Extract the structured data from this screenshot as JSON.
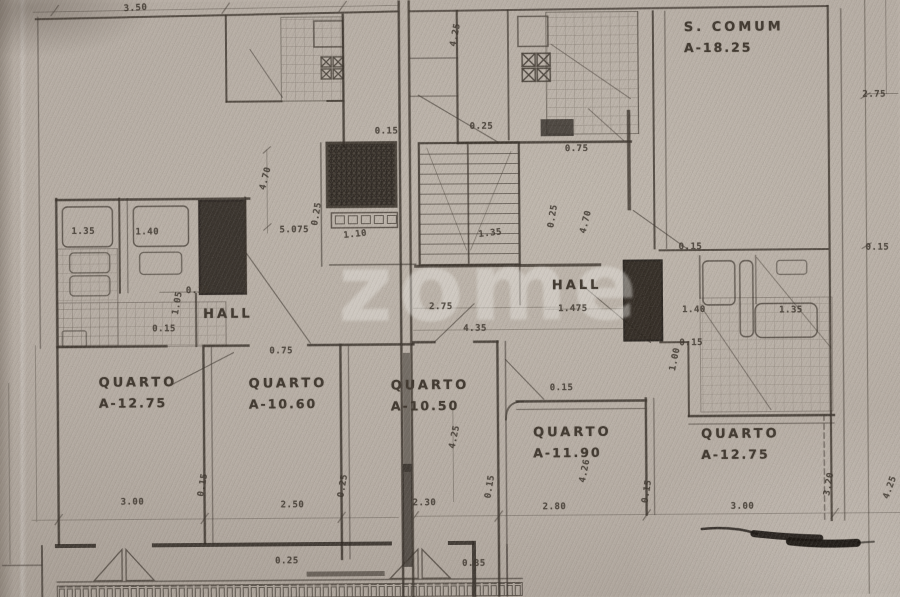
{
  "watermark": "zome",
  "rooms": [
    {
      "name": "S. COMUM",
      "area": "A-18.25",
      "x": 686,
      "y": 20
    },
    {
      "name": "HALL",
      "area": "",
      "x": 203,
      "y": 303
    },
    {
      "name": "HALL",
      "area": "",
      "x": 552,
      "y": 277
    },
    {
      "name": "QUARTO",
      "area": "A-12.75",
      "x": 98,
      "y": 371
    },
    {
      "name": "QUARTO",
      "area": "A-10.60",
      "x": 248,
      "y": 373
    },
    {
      "name": "QUARTO",
      "area": "A-10.50",
      "x": 390,
      "y": 376
    },
    {
      "name": "QUARTO",
      "area": "A-11.90",
      "x": 532,
      "y": 424
    },
    {
      "name": "QUARTO",
      "area": "A-12.75",
      "x": 700,
      "y": 427
    }
  ],
  "dimensions": [
    {
      "t": "3.50",
      "x": 126,
      "y": 1,
      "r": -3
    },
    {
      "t": "4.25",
      "x": 446,
      "y": 30,
      "r": -78
    },
    {
      "t": "0.15",
      "x": 376,
      "y": 126,
      "r": 0
    },
    {
      "t": "0.25",
      "x": 471,
      "y": 122,
      "r": 0
    },
    {
      "t": "0.75",
      "x": 566,
      "y": 145,
      "r": 0
    },
    {
      "t": "4.70",
      "x": 255,
      "y": 172,
      "r": -75
    },
    {
      "t": "0.25",
      "x": 306,
      "y": 208,
      "r": -80
    },
    {
      "t": "5.075",
      "x": 280,
      "y": 224,
      "r": 0
    },
    {
      "t": "1.10",
      "x": 344,
      "y": 229,
      "r": -6
    },
    {
      "t": "1.35",
      "x": 479,
      "y": 229,
      "r": -6
    },
    {
      "t": "0.25",
      "x": 542,
      "y": 212,
      "r": -80
    },
    {
      "t": "4.70",
      "x": 575,
      "y": 218,
      "r": -75
    },
    {
      "t": "1.35",
      "x": 72,
      "y": 224,
      "r": 0
    },
    {
      "t": "1.40",
      "x": 136,
      "y": 225,
      "r": 0
    },
    {
      "t": "0.15",
      "x": 186,
      "y": 284,
      "r": 0
    },
    {
      "t": "1.05",
      "x": 166,
      "y": 296,
      "r": -80
    },
    {
      "t": "0.15",
      "x": 152,
      "y": 322,
      "r": 0
    },
    {
      "t": "2.75",
      "x": 429,
      "y": 302,
      "r": 0
    },
    {
      "t": "1.475",
      "x": 558,
      "y": 305,
      "r": 0
    },
    {
      "t": "4.35",
      "x": 463,
      "y": 324,
      "r": 0
    },
    {
      "t": "0.75",
      "x": 269,
      "y": 345,
      "r": 0
    },
    {
      "t": "0.15",
      "x": 549,
      "y": 384,
      "r": 0
    },
    {
      "t": "4.25",
      "x": 442,
      "y": 432,
      "r": -78
    },
    {
      "t": "4.26",
      "x": 572,
      "y": 467,
      "r": -78
    },
    {
      "t": "0.15",
      "x": 679,
      "y": 244,
      "r": 0
    },
    {
      "t": "1.40",
      "x": 682,
      "y": 307,
      "r": 0
    },
    {
      "t": "1.35",
      "x": 779,
      "y": 308,
      "r": 0
    },
    {
      "t": "0.15",
      "x": 679,
      "y": 340,
      "r": 0
    },
    {
      "t": "1.00",
      "x": 663,
      "y": 356,
      "r": -78
    },
    {
      "t": "2.75",
      "x": 864,
      "y": 93,
      "r": 0
    },
    {
      "t": "0.15",
      "x": 866,
      "y": 246,
      "r": 0
    },
    {
      "t": "3.00",
      "x": 119,
      "y": 495,
      "r": 0
    },
    {
      "t": "0.15",
      "x": 190,
      "y": 478,
      "r": -80
    },
    {
      "t": "2.50",
      "x": 279,
      "y": 499,
      "r": 0
    },
    {
      "t": "0.25",
      "x": 330,
      "y": 480,
      "r": -80
    },
    {
      "t": "2.30",
      "x": 411,
      "y": 498,
      "r": 0
    },
    {
      "t": "0.15",
      "x": 477,
      "y": 482,
      "r": -80
    },
    {
      "t": "2.80",
      "x": 541,
      "y": 503,
      "r": 0
    },
    {
      "t": "0.15",
      "x": 634,
      "y": 488,
      "r": -80
    },
    {
      "t": "3.00",
      "x": 729,
      "y": 504,
      "r": 0
    },
    {
      "t": "3.20",
      "x": 816,
      "y": 482,
      "r": -80
    },
    {
      "t": "4.25",
      "x": 877,
      "y": 486,
      "r": -70
    },
    {
      "t": "0.25",
      "x": 273,
      "y": 555,
      "r": 0
    },
    {
      "t": "0.85",
      "x": 460,
      "y": 559,
      "r": 0
    }
  ]
}
